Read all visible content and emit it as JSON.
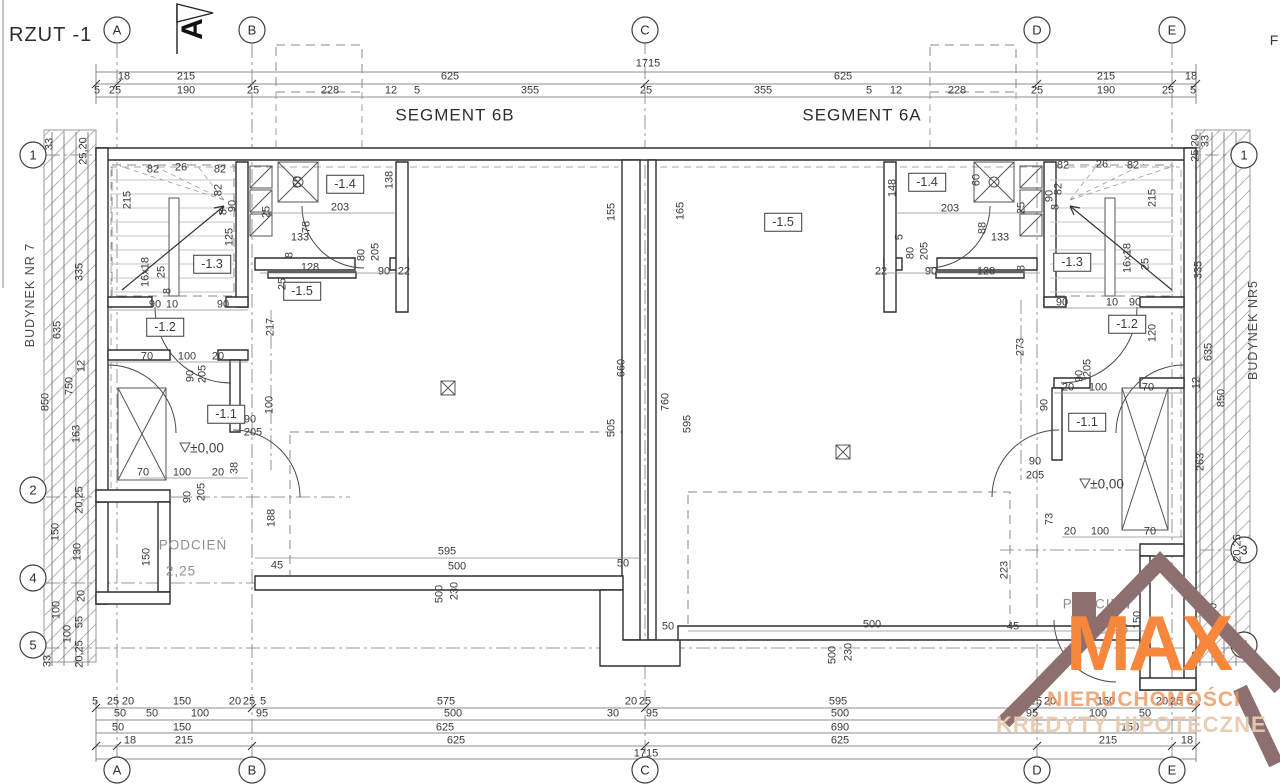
{
  "title": "RZUT -1",
  "logo": {
    "brand": "MAX",
    "line2": "NIERUCHOMOŚCI",
    "line3": "KREDYTY HIPOTECZNE",
    "roof_color": "#8d6f70",
    "brand_color": "#f6873c"
  },
  "colors": {
    "line": "#3a3a3a",
    "hatch": "#b5b5b5"
  },
  "texts": [
    {
      "t": "F",
      "x": 1274,
      "y": 40,
      "c": "big"
    },
    {
      "t": "A",
      "x": 193,
      "y": 29,
      "c": "north"
    },
    {
      "t": "SEGMENT 6B",
      "x": 455,
      "y": 115,
      "c": "seg"
    },
    {
      "t": "SEGMENT 6A",
      "x": 862,
      "y": 115,
      "c": "seg"
    },
    {
      "t": "BUDYNEK NR 7",
      "x": 30,
      "y": 295,
      "c": "bld"
    },
    {
      "t": "BUDYNEK NR5",
      "x": 1253,
      "y": 330,
      "c": "bld"
    },
    {
      "t": "A",
      "x": 117,
      "y": 30,
      "c": "ax"
    },
    {
      "t": "B",
      "x": 252,
      "y": 30,
      "c": "ax"
    },
    {
      "t": "C",
      "x": 645,
      "y": 30,
      "c": "ax"
    },
    {
      "t": "D",
      "x": 1037,
      "y": 30,
      "c": "ax"
    },
    {
      "t": "E",
      "x": 1172,
      "y": 30,
      "c": "ax"
    },
    {
      "t": "A",
      "x": 117,
      "y": 770,
      "c": "ax"
    },
    {
      "t": "B",
      "x": 252,
      "y": 770,
      "c": "ax"
    },
    {
      "t": "C",
      "x": 645,
      "y": 770,
      "c": "ax"
    },
    {
      "t": "D",
      "x": 1037,
      "y": 770,
      "c": "ax"
    },
    {
      "t": "E",
      "x": 1172,
      "y": 770,
      "c": "ax"
    },
    {
      "t": "1",
      "x": 33,
      "y": 155,
      "c": "ax"
    },
    {
      "t": "2",
      "x": 33,
      "y": 490,
      "c": "ax"
    },
    {
      "t": "4",
      "x": 33,
      "y": 578,
      "c": "ax"
    },
    {
      "t": "5",
      "x": 33,
      "y": 645,
      "c": "ax"
    },
    {
      "t": "1",
      "x": 1244,
      "y": 155,
      "c": "ax"
    },
    {
      "t": "3",
      "x": 1244,
      "y": 550,
      "c": "ax"
    },
    {
      "t": "5",
      "x": 1244,
      "y": 645,
      "c": "ax"
    },
    {
      "t": "-1.3",
      "x": 212,
      "y": 264,
      "c": "room"
    },
    {
      "t": "-1.2",
      "x": 165,
      "y": 327,
      "c": "room"
    },
    {
      "t": "-1.1",
      "x": 226,
      "y": 414,
      "c": "room"
    },
    {
      "t": "-1.4",
      "x": 345,
      "y": 184,
      "c": "room"
    },
    {
      "t": "-1.5",
      "x": 302,
      "y": 291,
      "c": "room"
    },
    {
      "t": "-1.5",
      "x": 783,
      "y": 222,
      "c": "room"
    },
    {
      "t": "-1.4",
      "x": 927,
      "y": 182,
      "c": "room"
    },
    {
      "t": "-1.3",
      "x": 1072,
      "y": 262,
      "c": "room"
    },
    {
      "t": "-1.2",
      "x": 1127,
      "y": 324,
      "c": "room"
    },
    {
      "t": "-1.1",
      "x": 1087,
      "y": 422,
      "c": "room"
    },
    {
      "t": "PODCIEŃ",
      "x": 193,
      "y": 545,
      "c": "pod"
    },
    {
      "t": "2,25",
      "x": 181,
      "y": 571,
      "c": "pod"
    },
    {
      "t": "PODCIEŃ",
      "x": 1097,
      "y": 604,
      "c": "pod"
    },
    {
      "t": "2,25",
      "x": 1114,
      "y": 629,
      "c": "pod"
    },
    {
      "t": "±0,00",
      "x": 207,
      "y": 448,
      "c": "lvl"
    },
    {
      "t": "±0,00",
      "x": 1107,
      "y": 484,
      "c": "lvl"
    },
    {
      "t": "1715",
      "x": 648,
      "y": 64,
      "c": "d"
    },
    {
      "t": "18",
      "x": 124,
      "y": 77,
      "c": "d"
    },
    {
      "t": "215",
      "x": 186,
      "y": 77,
      "c": "d"
    },
    {
      "t": "625",
      "x": 450,
      "y": 77,
      "c": "d"
    },
    {
      "t": "625",
      "x": 843,
      "y": 77,
      "c": "d"
    },
    {
      "t": "215",
      "x": 1106,
      "y": 77,
      "c": "d"
    },
    {
      "t": "18",
      "x": 1191,
      "y": 77,
      "c": "d"
    },
    {
      "t": "5",
      "x": 97,
      "y": 91,
      "c": "d"
    },
    {
      "t": "25",
      "x": 115,
      "y": 91,
      "c": "d"
    },
    {
      "t": "190",
      "x": 186,
      "y": 91,
      "c": "d"
    },
    {
      "t": "25",
      "x": 253,
      "y": 91,
      "c": "d"
    },
    {
      "t": "228",
      "x": 330,
      "y": 91,
      "c": "d"
    },
    {
      "t": "12",
      "x": 391,
      "y": 91,
      "c": "d"
    },
    {
      "t": "5",
      "x": 417,
      "y": 91,
      "c": "d"
    },
    {
      "t": "355",
      "x": 530,
      "y": 91,
      "c": "d"
    },
    {
      "t": "25",
      "x": 646,
      "y": 91,
      "c": "d"
    },
    {
      "t": "355",
      "x": 763,
      "y": 91,
      "c": "d"
    },
    {
      "t": "5",
      "x": 869,
      "y": 91,
      "c": "d"
    },
    {
      "t": "12",
      "x": 896,
      "y": 91,
      "c": "d"
    },
    {
      "t": "228",
      "x": 957,
      "y": 91,
      "c": "d"
    },
    {
      "t": "25",
      "x": 1037,
      "y": 91,
      "c": "d"
    },
    {
      "t": "190",
      "x": 1106,
      "y": 91,
      "c": "d"
    },
    {
      "t": "25",
      "x": 1168,
      "y": 91,
      "c": "d"
    },
    {
      "t": "5",
      "x": 1193,
      "y": 91,
      "c": "d"
    },
    {
      "t": "5",
      "x": 95,
      "y": 702,
      "c": "d"
    },
    {
      "t": "25",
      "x": 113,
      "y": 702,
      "c": "d"
    },
    {
      "t": "20",
      "x": 128,
      "y": 702,
      "c": "d"
    },
    {
      "t": "150",
      "x": 182,
      "y": 702,
      "c": "d"
    },
    {
      "t": "20",
      "x": 235,
      "y": 702,
      "c": "d"
    },
    {
      "t": "25",
      "x": 249,
      "y": 702,
      "c": "d"
    },
    {
      "t": "5",
      "x": 263,
      "y": 702,
      "c": "d"
    },
    {
      "t": "575",
      "x": 446,
      "y": 702,
      "c": "d"
    },
    {
      "t": "20",
      "x": 631,
      "y": 702,
      "c": "d"
    },
    {
      "t": "25",
      "x": 645,
      "y": 702,
      "c": "d"
    },
    {
      "t": "595",
      "x": 838,
      "y": 702,
      "c": "d"
    },
    {
      "t": "5",
      "x": 1022,
      "y": 702,
      "c": "d"
    },
    {
      "t": "25",
      "x": 1036,
      "y": 702,
      "c": "d"
    },
    {
      "t": "20",
      "x": 1050,
      "y": 702,
      "c": "d"
    },
    {
      "t": "150",
      "x": 1106,
      "y": 702,
      "c": "d"
    },
    {
      "t": "20",
      "x": 1162,
      "y": 702,
      "c": "d"
    },
    {
      "t": "25",
      "x": 1176,
      "y": 702,
      "c": "d"
    },
    {
      "t": "5",
      "x": 1190,
      "y": 702,
      "c": "d"
    },
    {
      "t": "50",
      "x": 120,
      "y": 714,
      "c": "d"
    },
    {
      "t": "50",
      "x": 152,
      "y": 714,
      "c": "d"
    },
    {
      "t": "100",
      "x": 200,
      "y": 714,
      "c": "d"
    },
    {
      "t": "95",
      "x": 262,
      "y": 714,
      "c": "d"
    },
    {
      "t": "500",
      "x": 453,
      "y": 714,
      "c": "d"
    },
    {
      "t": "30",
      "x": 613,
      "y": 714,
      "c": "d"
    },
    {
      "t": "95",
      "x": 652,
      "y": 714,
      "c": "d"
    },
    {
      "t": "500",
      "x": 840,
      "y": 714,
      "c": "d"
    },
    {
      "t": "95",
      "x": 1032,
      "y": 714,
      "c": "d"
    },
    {
      "t": "100",
      "x": 1098,
      "y": 714,
      "c": "d"
    },
    {
      "t": "50",
      "x": 1145,
      "y": 714,
      "c": "d"
    },
    {
      "t": "50",
      "x": 118,
      "y": 728,
      "c": "d"
    },
    {
      "t": "150",
      "x": 182,
      "y": 728,
      "c": "d"
    },
    {
      "t": "625",
      "x": 445,
      "y": 728,
      "c": "d"
    },
    {
      "t": "690",
      "x": 840,
      "y": 728,
      "c": "d"
    },
    {
      "t": "150",
      "x": 1130,
      "y": 728,
      "c": "d"
    },
    {
      "t": "18",
      "x": 130,
      "y": 741,
      "c": "d"
    },
    {
      "t": "215",
      "x": 184,
      "y": 741,
      "c": "d"
    },
    {
      "t": "625",
      "x": 456,
      "y": 741,
      "c": "d"
    },
    {
      "t": "625",
      "x": 840,
      "y": 741,
      "c": "d"
    },
    {
      "t": "215",
      "x": 1108,
      "y": 741,
      "c": "d"
    },
    {
      "t": "18",
      "x": 1187,
      "y": 741,
      "c": "d"
    },
    {
      "t": "1715",
      "x": 646,
      "y": 754,
      "c": "d"
    },
    {
      "t": "33",
      "x": 50,
      "y": 144,
      "c": "dv"
    },
    {
      "t": "25,20",
      "x": 84,
      "y": 151,
      "c": "dv"
    },
    {
      "t": "335",
      "x": 80,
      "y": 272,
      "c": "dv"
    },
    {
      "t": "635",
      "x": 58,
      "y": 330,
      "c": "dv"
    },
    {
      "t": "12",
      "x": 82,
      "y": 366,
      "c": "dv"
    },
    {
      "t": "750",
      "x": 70,
      "y": 386,
      "c": "dv"
    },
    {
      "t": "850",
      "x": 46,
      "y": 402,
      "c": "dv"
    },
    {
      "t": "163",
      "x": 77,
      "y": 434,
      "c": "dv"
    },
    {
      "t": "20,25",
      "x": 80,
      "y": 500,
      "c": "dv"
    },
    {
      "t": "150",
      "x": 56,
      "y": 532,
      "c": "dv"
    },
    {
      "t": "130",
      "x": 78,
      "y": 552,
      "c": "dv"
    },
    {
      "t": "20",
      "x": 82,
      "y": 596,
      "c": "dv"
    },
    {
      "t": "100",
      "x": 57,
      "y": 610,
      "c": "dv"
    },
    {
      "t": "55",
      "x": 80,
      "y": 622,
      "c": "dv"
    },
    {
      "t": "100",
      "x": 68,
      "y": 634,
      "c": "dv"
    },
    {
      "t": "20,25",
      "x": 80,
      "y": 654,
      "c": "dv"
    },
    {
      "t": "33",
      "x": 48,
      "y": 661,
      "c": "dv"
    },
    {
      "t": "25,20",
      "x": 1196,
      "y": 148,
      "c": "dv"
    },
    {
      "t": "33",
      "x": 1206,
      "y": 141,
      "c": "dv"
    },
    {
      "t": "335",
      "x": 1199,
      "y": 270,
      "c": "dv"
    },
    {
      "t": "635",
      "x": 1209,
      "y": 352,
      "c": "dv"
    },
    {
      "t": "12",
      "x": 1197,
      "y": 383,
      "c": "dv"
    },
    {
      "t": "850",
      "x": 1222,
      "y": 398,
      "c": "dv"
    },
    {
      "t": "263",
      "x": 1201,
      "y": 462,
      "c": "dv"
    },
    {
      "t": "20,25",
      "x": 1238,
      "y": 548,
      "c": "dv"
    },
    {
      "t": "150",
      "x": 1214,
      "y": 612,
      "c": "dv"
    },
    {
      "t": "32",
      "x": 1197,
      "y": 657,
      "c": "dv"
    },
    {
      "t": "82",
      "x": 153,
      "y": 170,
      "c": "d"
    },
    {
      "t": "26",
      "x": 181,
      "y": 168,
      "c": "d"
    },
    {
      "t": "82",
      "x": 220,
      "y": 170,
      "c": "d"
    },
    {
      "t": "215",
      "x": 128,
      "y": 200,
      "c": "dv"
    },
    {
      "t": "82",
      "x": 219,
      "y": 190,
      "c": "dv"
    },
    {
      "t": "8",
      "x": 224,
      "y": 212,
      "c": "dv"
    },
    {
      "t": "90",
      "x": 233,
      "y": 206,
      "c": "dv"
    },
    {
      "t": "125",
      "x": 230,
      "y": 237,
      "c": "dv"
    },
    {
      "t": "16x18",
      "x": 146,
      "y": 272,
      "c": "dv"
    },
    {
      "t": "25",
      "x": 162,
      "y": 272,
      "c": "dv"
    },
    {
      "t": "8",
      "x": 168,
      "y": 291,
      "c": "dv"
    },
    {
      "t": "90",
      "x": 155,
      "y": 305,
      "c": "d"
    },
    {
      "t": "10",
      "x": 172,
      "y": 305,
      "c": "d"
    },
    {
      "t": "90",
      "x": 223,
      "y": 305,
      "c": "d"
    },
    {
      "t": "70",
      "x": 147,
      "y": 357,
      "c": "d"
    },
    {
      "t": "100",
      "x": 187,
      "y": 357,
      "c": "d"
    },
    {
      "t": "20",
      "x": 218,
      "y": 357,
      "c": "d"
    },
    {
      "t": "90",
      "x": 191,
      "y": 376,
      "c": "dv"
    },
    {
      "t": "205",
      "x": 203,
      "y": 374,
      "c": "dv"
    },
    {
      "t": "217",
      "x": 271,
      "y": 327,
      "c": "dv"
    },
    {
      "t": "100",
      "x": 270,
      "y": 405,
      "c": "dv"
    },
    {
      "t": "60",
      "x": 298,
      "y": 182,
      "c": "dv"
    },
    {
      "t": "138",
      "x": 390,
      "y": 180,
      "c": "dv"
    },
    {
      "t": "203",
      "x": 340,
      "y": 208,
      "c": "d"
    },
    {
      "t": "78",
      "x": 307,
      "y": 227,
      "c": "dv"
    },
    {
      "t": "133",
      "x": 300,
      "y": 238,
      "c": "d"
    },
    {
      "t": "25",
      "x": 267,
      "y": 212,
      "c": "dv"
    },
    {
      "t": "128",
      "x": 310,
      "y": 268,
      "c": "d"
    },
    {
      "t": "8",
      "x": 290,
      "y": 255,
      "c": "dv"
    },
    {
      "t": "80",
      "x": 362,
      "y": 255,
      "c": "dv"
    },
    {
      "t": "205",
      "x": 376,
      "y": 252,
      "c": "dv"
    },
    {
      "t": "90",
      "x": 384,
      "y": 272,
      "c": "d"
    },
    {
      "t": "22",
      "x": 404,
      "y": 272,
      "c": "d"
    },
    {
      "t": "25",
      "x": 283,
      "y": 284,
      "c": "dv"
    },
    {
      "t": "155",
      "x": 612,
      "y": 212,
      "c": "dv"
    },
    {
      "t": "165",
      "x": 681,
      "y": 211,
      "c": "dv"
    },
    {
      "t": "660",
      "x": 622,
      "y": 368,
      "c": "dv"
    },
    {
      "t": "505",
      "x": 612,
      "y": 428,
      "c": "dv"
    },
    {
      "t": "760",
      "x": 666,
      "y": 402,
      "c": "dv"
    },
    {
      "t": "595",
      "x": 688,
      "y": 424,
      "c": "dv"
    },
    {
      "t": "595",
      "x": 447,
      "y": 552,
      "c": "d"
    },
    {
      "t": "500",
      "x": 457,
      "y": 567,
      "c": "d"
    },
    {
      "t": "45",
      "x": 277,
      "y": 566,
      "c": "d"
    },
    {
      "t": "50",
      "x": 623,
      "y": 564,
      "c": "d"
    },
    {
      "t": "500",
      "x": 440,
      "y": 594,
      "c": "dv"
    },
    {
      "t": "230",
      "x": 455,
      "y": 591,
      "c": "dv"
    },
    {
      "t": "70",
      "x": 143,
      "y": 473,
      "c": "d"
    },
    {
      "t": "100",
      "x": 182,
      "y": 473,
      "c": "d"
    },
    {
      "t": "20",
      "x": 218,
      "y": 473,
      "c": "d"
    },
    {
      "t": "38",
      "x": 235,
      "y": 468,
      "c": "dv"
    },
    {
      "t": "90",
      "x": 188,
      "y": 497,
      "c": "dv"
    },
    {
      "t": "205",
      "x": 202,
      "y": 492,
      "c": "dv"
    },
    {
      "t": "150",
      "x": 147,
      "y": 557,
      "c": "dv"
    },
    {
      "t": "188",
      "x": 272,
      "y": 518,
      "c": "dv"
    },
    {
      "t": "90",
      "x": 250,
      "y": 420,
      "c": "d"
    },
    {
      "t": "205",
      "x": 253,
      "y": 433,
      "c": "d"
    },
    {
      "t": "148",
      "x": 893,
      "y": 188,
      "c": "dv"
    },
    {
      "t": "60",
      "x": 977,
      "y": 180,
      "c": "dv"
    },
    {
      "t": "203",
      "x": 950,
      "y": 209,
      "c": "d"
    },
    {
      "t": "88",
      "x": 983,
      "y": 228,
      "c": "dv"
    },
    {
      "t": "133",
      "x": 1000,
      "y": 238,
      "c": "d"
    },
    {
      "t": "25",
      "x": 1022,
      "y": 208,
      "c": "dv"
    },
    {
      "t": "5",
      "x": 900,
      "y": 237,
      "c": "dv"
    },
    {
      "t": "80",
      "x": 911,
      "y": 253,
      "c": "dv"
    },
    {
      "t": "205",
      "x": 925,
      "y": 251,
      "c": "dv"
    },
    {
      "t": "22",
      "x": 881,
      "y": 272,
      "c": "d"
    },
    {
      "t": "90",
      "x": 931,
      "y": 272,
      "c": "d"
    },
    {
      "t": "128",
      "x": 986,
      "y": 272,
      "c": "d"
    },
    {
      "t": "8",
      "x": 1022,
      "y": 268,
      "c": "dv"
    },
    {
      "t": "82",
      "x": 1063,
      "y": 166,
      "c": "d"
    },
    {
      "t": "26",
      "x": 1102,
      "y": 165,
      "c": "d"
    },
    {
      "t": "82",
      "x": 1133,
      "y": 166,
      "c": "d"
    },
    {
      "t": "90",
      "x": 1050,
      "y": 196,
      "c": "dv"
    },
    {
      "t": "82",
      "x": 1059,
      "y": 189,
      "c": "dv"
    },
    {
      "t": "8",
      "x": 1056,
      "y": 207,
      "c": "dv"
    },
    {
      "t": "215",
      "x": 1153,
      "y": 198,
      "c": "dv"
    },
    {
      "t": "16x18",
      "x": 1128,
      "y": 258,
      "c": "dv"
    },
    {
      "t": "25",
      "x": 1146,
      "y": 264,
      "c": "dv"
    },
    {
      "t": "90",
      "x": 1062,
      "y": 303,
      "c": "d"
    },
    {
      "t": "10",
      "x": 1112,
      "y": 303,
      "c": "d"
    },
    {
      "t": "90",
      "x": 1135,
      "y": 303,
      "c": "d"
    },
    {
      "t": "120",
      "x": 1153,
      "y": 333,
      "c": "dv"
    },
    {
      "t": "205",
      "x": 1088,
      "y": 368,
      "c": "dv"
    },
    {
      "t": "90",
      "x": 1080,
      "y": 376,
      "c": "dv"
    },
    {
      "t": "20",
      "x": 1068,
      "y": 388,
      "c": "d"
    },
    {
      "t": "100",
      "x": 1098,
      "y": 388,
      "c": "d"
    },
    {
      "t": "70",
      "x": 1148,
      "y": 388,
      "c": "d"
    },
    {
      "t": "90",
      "x": 1045,
      "y": 405,
      "c": "dv"
    },
    {
      "t": "273",
      "x": 1021,
      "y": 347,
      "c": "dv"
    },
    {
      "t": "90",
      "x": 1035,
      "y": 462,
      "c": "d"
    },
    {
      "t": "205",
      "x": 1035,
      "y": 476,
      "c": "d"
    },
    {
      "t": "73",
      "x": 1050,
      "y": 519,
      "c": "dv"
    },
    {
      "t": "20",
      "x": 1070,
      "y": 532,
      "c": "d"
    },
    {
      "t": "100",
      "x": 1100,
      "y": 532,
      "c": "d"
    },
    {
      "t": "70",
      "x": 1150,
      "y": 532,
      "c": "d"
    },
    {
      "t": "223",
      "x": 1005,
      "y": 570,
      "c": "dv"
    },
    {
      "t": "150",
      "x": 1138,
      "y": 620,
      "c": "dv"
    },
    {
      "t": "50",
      "x": 668,
      "y": 627,
      "c": "d"
    },
    {
      "t": "500",
      "x": 872,
      "y": 625,
      "c": "d"
    },
    {
      "t": "45",
      "x": 1013,
      "y": 627,
      "c": "d"
    },
    {
      "t": "500",
      "x": 833,
      "y": 655,
      "c": "dv"
    },
    {
      "t": "230",
      "x": 849,
      "y": 652,
      "c": "dv"
    }
  ]
}
